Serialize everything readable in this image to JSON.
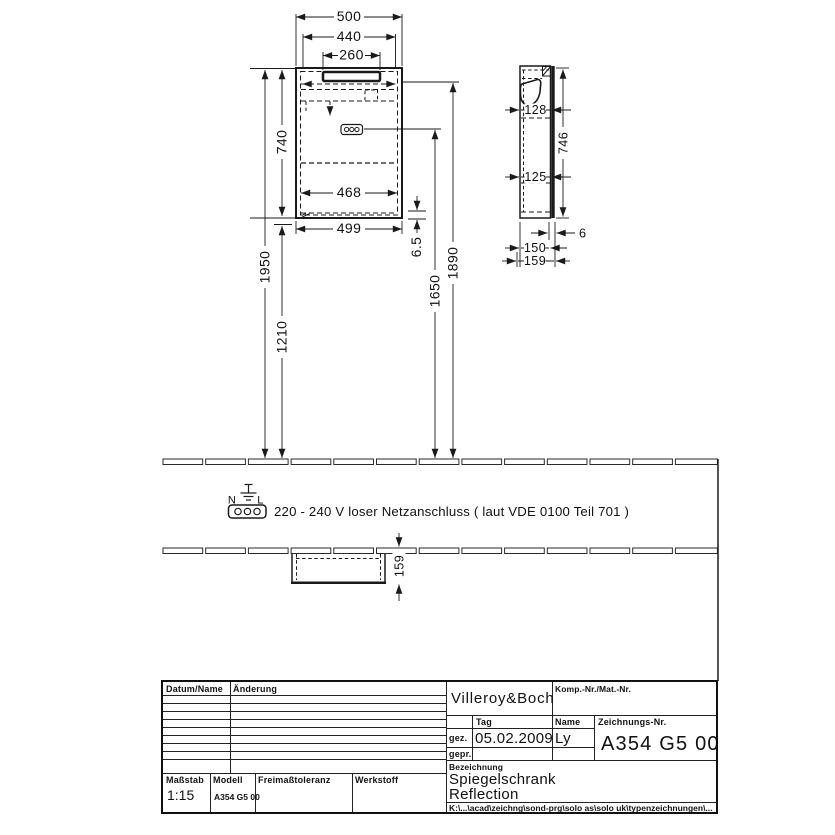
{
  "drawing": {
    "front_view": {
      "dim_500": "500",
      "dim_440": "440",
      "dim_260": "260",
      "dim_740": "740",
      "dim_1950": "1950",
      "dim_1210": "1210",
      "dim_468": "468",
      "dim_499": "499",
      "dim_6_5": "6.5",
      "dim_1650": "1650",
      "dim_1890": "1890"
    },
    "side_view": {
      "dim_128": "128",
      "dim_125": "125",
      "dim_746": "746",
      "dim_6": "6",
      "dim_150": "150",
      "dim_159": "159"
    },
    "plan_view": {
      "dim_159": "159"
    },
    "electrical": {
      "label_n": "N",
      "label_l": "L",
      "note": "220 - 240 V loser Netzanschluss ( laut VDE 0100 Teil 701 )"
    }
  },
  "title_block": {
    "revision": {
      "col_date_name": "Datum/Name",
      "col_change": "Änderung"
    },
    "scale": {
      "label": "Maßstab",
      "value": "1:15"
    },
    "model": {
      "label": "Modell",
      "value": "A354 G5 00"
    },
    "tolerance_label": "Freimaßtoleranz",
    "material_label": "Werkstoff",
    "brand": "Villeroy&Boch",
    "comp_nr_label": "Komp.-Nr./Mat.-Nr.",
    "date_label": "Tag",
    "name_label": "Name",
    "drawn_label": "gez.",
    "checked_label": "gepr.",
    "drawn_date": "05.02.2009",
    "drawn_name": "Ly",
    "drawing_nr": {
      "label": "Zeichnungs-Nr.",
      "value": "A354 G5 00"
    },
    "designation": {
      "label": "Bezeichnung",
      "line1": "Spiegelschrank",
      "line2": "Reflection"
    },
    "file_path": "K:\\...\\acad\\zeichng\\sond-prg\\solo as\\solo uk\\typenzeichnungen\\..."
  }
}
